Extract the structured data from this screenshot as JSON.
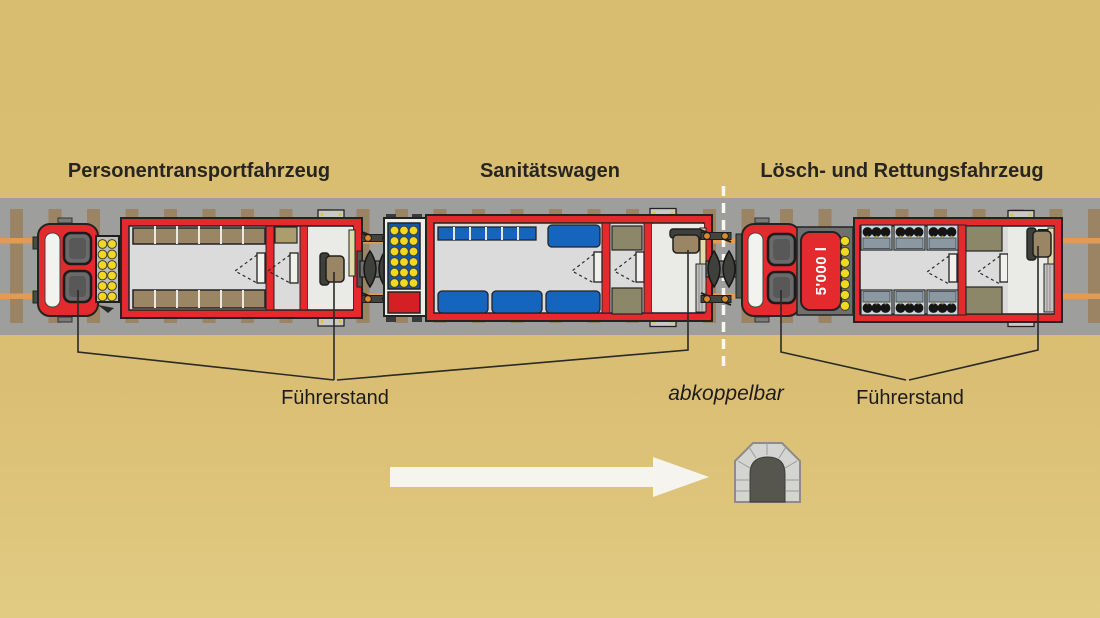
{
  "diagram": {
    "background_color": "#D9BD71",
    "track": {
      "bed_color": "#9E9E9D",
      "tie_color": "#9A8464",
      "rail_color": "#E29B54"
    },
    "vehicles": [
      {
        "id": "personentransportfahrzeug",
        "title": "Personentransportfahrzeug"
      },
      {
        "id": "sanitaetswagen",
        "title": "Sanitätswagen"
      },
      {
        "id": "loesch-und-rettungsfahrzeug",
        "title": "Lösch- und Rettungsfahrzeug"
      }
    ],
    "annotations": {
      "driver_cab_label_left": "Führerstand",
      "driver_cab_label_right": "Führerstand",
      "detachable_label": "abkoppelbar",
      "tank_capacity_label": "5'000 l"
    },
    "colors": {
      "train_red": "#E42A2C",
      "interior_gray": "#DBDBDB",
      "seat_brown": "#9A8565",
      "signal_yellow": "#F2D723",
      "medical_blue": "#1565BE",
      "panel_blue": "#1456AC",
      "cabinet_olive": "#8D8769",
      "crew_bench_slate": "#8B97A1",
      "console_khaki": "#E3D9A8",
      "arrow_white": "#F5F4EF",
      "dashed_line_white": "#F8F7F2"
    },
    "icons": {
      "tunnel": "tunnel-icon",
      "direction_arrow": "direction-arrow-icon"
    }
  }
}
